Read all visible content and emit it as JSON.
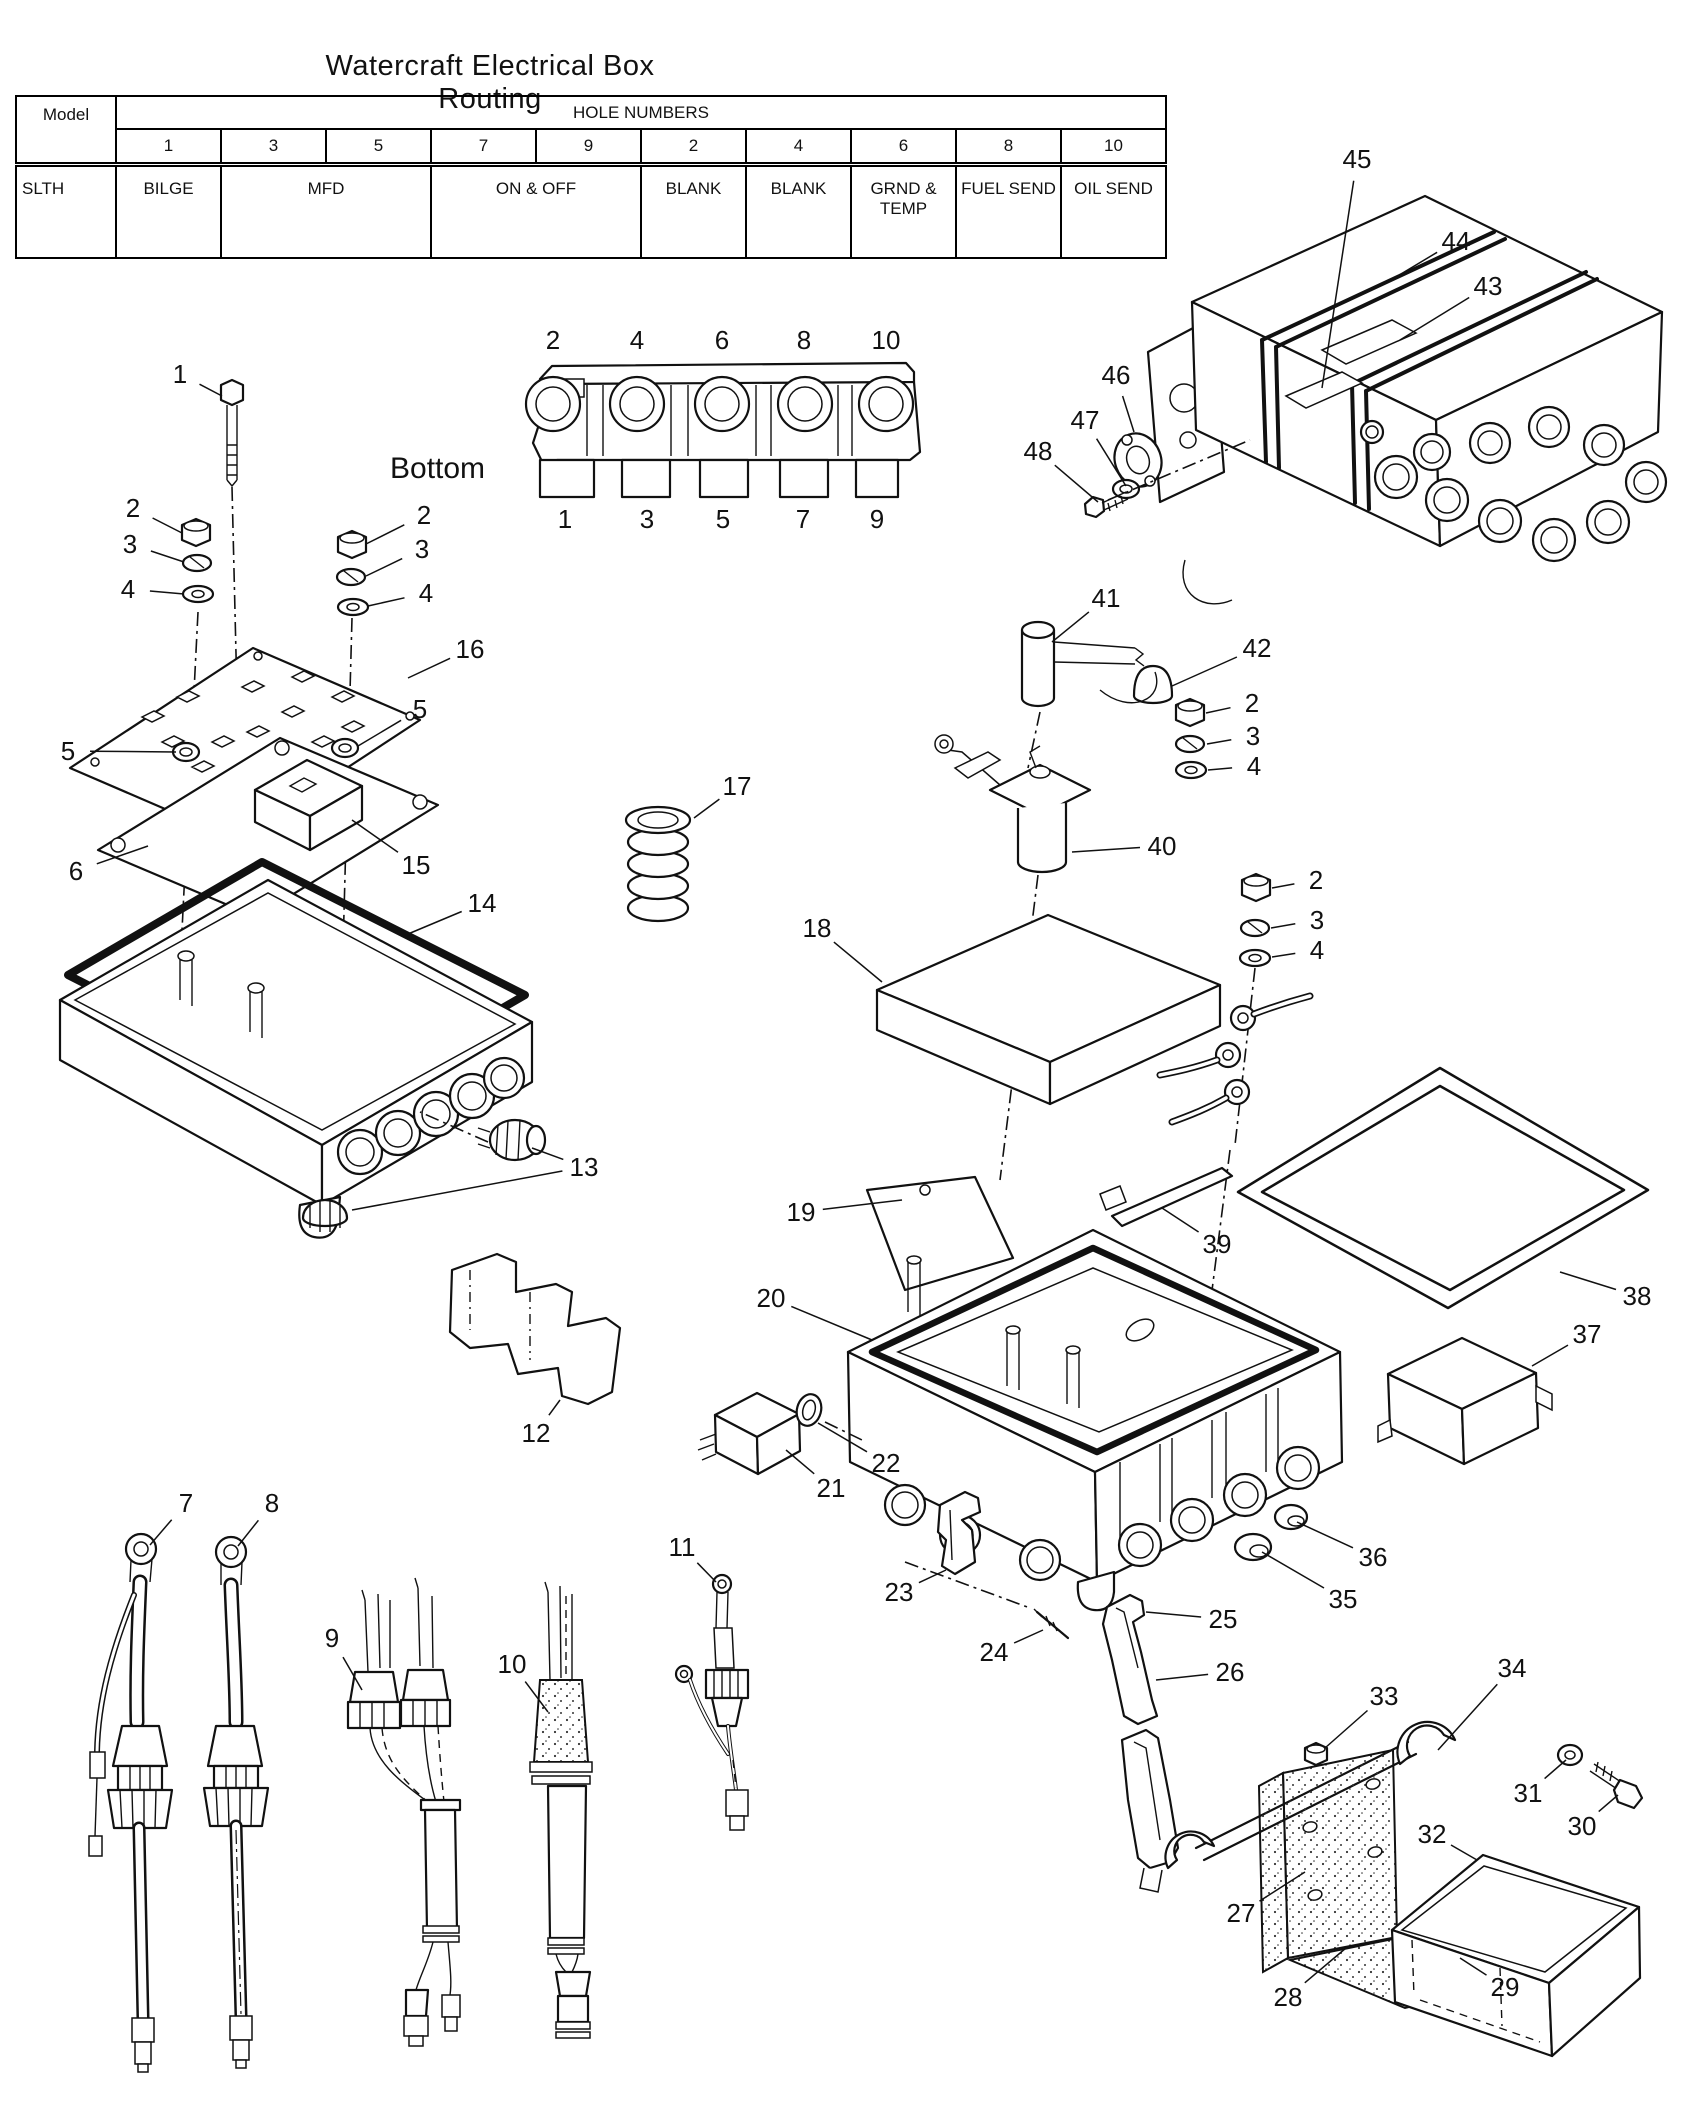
{
  "title": "Watercraft Electrical Box Routing",
  "table": {
    "model_header": "Model",
    "group_header": "HOLE NUMBERS",
    "hole_numbers": [
      "1",
      "3",
      "5",
      "7",
      "9",
      "2",
      "4",
      "6",
      "8",
      "10"
    ],
    "model_value": "SLTH",
    "assignments": [
      {
        "label": "BILGE",
        "span": 1
      },
      {
        "label": "MFD",
        "span": 2
      },
      {
        "label": "ON & OFF",
        "span": 2
      },
      {
        "label": "BLANK",
        "span": 1
      },
      {
        "label": "BLANK",
        "span": 1
      },
      {
        "label": "GRND & TEMP",
        "span": 1
      },
      {
        "label": "FUEL SEND",
        "span": 1
      },
      {
        "label": "OIL SEND",
        "span": 1
      }
    ]
  },
  "bottom_view": {
    "label": "Bottom",
    "top_row": [
      {
        "n": "2",
        "x": 553
      },
      {
        "n": "4",
        "x": 637
      },
      {
        "n": "6",
        "x": 722
      },
      {
        "n": "8",
        "x": 804
      },
      {
        "n": "10",
        "x": 886
      }
    ],
    "bottom_row": [
      {
        "n": "1",
        "x": 565
      },
      {
        "n": "3",
        "x": 647
      },
      {
        "n": "5",
        "x": 723
      },
      {
        "n": "7",
        "x": 803
      },
      {
        "n": "9",
        "x": 877
      }
    ]
  },
  "callouts": [
    {
      "label": "1",
      "x": 180,
      "y": 383,
      "tx": 222,
      "ty": 396
    },
    {
      "label": "2",
      "x": 133,
      "y": 517,
      "tx": 182,
      "ty": 533
    },
    {
      "label": "3",
      "x": 130,
      "y": 553,
      "tx": 184,
      "ty": 562
    },
    {
      "label": "4",
      "x": 128,
      "y": 598,
      "tx": 184,
      "ty": 594
    },
    {
      "label": "2",
      "x": 424,
      "y": 524,
      "tx": 366,
      "ty": 544
    },
    {
      "label": "3",
      "x": 422,
      "y": 558,
      "tx": 366,
      "ty": 576
    },
    {
      "label": "4",
      "x": 426,
      "y": 602,
      "tx": 368,
      "ty": 606
    },
    {
      "label": "5",
      "x": 68,
      "y": 760,
      "tx": 176,
      "ty": 752
    },
    {
      "label": "5",
      "x": 420,
      "y": 718,
      "tx": 358,
      "ty": 746
    },
    {
      "label": "16",
      "x": 470,
      "y": 658,
      "tx": 408,
      "ty": 678
    },
    {
      "label": "6",
      "x": 76,
      "y": 880,
      "tx": 148,
      "ty": 846
    },
    {
      "label": "15",
      "x": 416,
      "y": 874,
      "tx": 352,
      "ty": 820
    },
    {
      "label": "14",
      "x": 482,
      "y": 912,
      "tx": 408,
      "ty": 934
    },
    {
      "label": "13",
      "x": 584,
      "y": 1176,
      "tx": 532,
      "ty": 1148,
      "tx2": 352,
      "ty2": 1210
    },
    {
      "label": "12",
      "x": 536,
      "y": 1442,
      "tx": 560,
      "ty": 1400
    },
    {
      "label": "7",
      "x": 186,
      "y": 1512,
      "tx": 150,
      "ty": 1545
    },
    {
      "label": "8",
      "x": 272,
      "y": 1512,
      "tx": 238,
      "ty": 1546
    },
    {
      "label": "9",
      "x": 332,
      "y": 1647,
      "tx": 362,
      "ty": 1690
    },
    {
      "label": "10",
      "x": 512,
      "y": 1673,
      "tx": 548,
      "ty": 1712
    },
    {
      "label": "11",
      "x": 682,
      "y": 1556,
      "tx": 716,
      "ty": 1582
    },
    {
      "label": "17",
      "x": 737,
      "y": 795,
      "tx": 694,
      "ty": 818
    },
    {
      "label": "18",
      "x": 817,
      "y": 937,
      "tx": 882,
      "ty": 982
    },
    {
      "label": "40",
      "x": 1162,
      "y": 855,
      "tx": 1072,
      "ty": 852
    },
    {
      "label": "41",
      "x": 1106,
      "y": 607,
      "tx": 1052,
      "ty": 642
    },
    {
      "label": "42",
      "x": 1257,
      "y": 657,
      "tx": 1172,
      "ty": 686
    },
    {
      "label": "2",
      "x": 1252,
      "y": 712,
      "tx": 1206,
      "ty": 713
    },
    {
      "label": "3",
      "x": 1253,
      "y": 745,
      "tx": 1207,
      "ty": 744
    },
    {
      "label": "4",
      "x": 1254,
      "y": 775,
      "tx": 1208,
      "ty": 770
    },
    {
      "label": "2",
      "x": 1316,
      "y": 889,
      "tx": 1272,
      "ty": 888
    },
    {
      "label": "3",
      "x": 1317,
      "y": 929,
      "tx": 1271,
      "ty": 928
    },
    {
      "label": "4",
      "x": 1317,
      "y": 959,
      "tx": 1272,
      "ty": 957
    },
    {
      "label": "19",
      "x": 801,
      "y": 1221,
      "tx": 902,
      "ty": 1200
    },
    {
      "label": "20",
      "x": 771,
      "y": 1307,
      "tx": 872,
      "ty": 1340
    },
    {
      "label": "21",
      "x": 831,
      "y": 1497,
      "tx": 786,
      "ty": 1450
    },
    {
      "label": "22",
      "x": 886,
      "y": 1472,
      "tx": 818,
      "ty": 1423
    },
    {
      "label": "23",
      "x": 899,
      "y": 1601,
      "tx": 946,
      "ty": 1570
    },
    {
      "label": "24",
      "x": 994,
      "y": 1661,
      "tx": 1043,
      "ty": 1630
    },
    {
      "label": "25",
      "x": 1223,
      "y": 1628,
      "tx": 1146,
      "ty": 1612
    },
    {
      "label": "26",
      "x": 1230,
      "y": 1681,
      "tx": 1156,
      "ty": 1680
    },
    {
      "label": "35",
      "x": 1343,
      "y": 1608,
      "tx": 1262,
      "ty": 1552
    },
    {
      "label": "36",
      "x": 1373,
      "y": 1566,
      "tx": 1297,
      "ty": 1522
    },
    {
      "label": "37",
      "x": 1587,
      "y": 1343,
      "tx": 1532,
      "ty": 1366
    },
    {
      "label": "38",
      "x": 1637,
      "y": 1305,
      "tx": 1560,
      "ty": 1272
    },
    {
      "label": "39",
      "x": 1217,
      "y": 1253,
      "tx": 1162,
      "ty": 1208
    },
    {
      "label": "43",
      "x": 1488,
      "y": 295,
      "tx": 1400,
      "ty": 340
    },
    {
      "label": "44",
      "x": 1456,
      "y": 250,
      "tx": 1396,
      "ty": 277
    },
    {
      "label": "45",
      "x": 1357,
      "y": 168,
      "tx": 1322,
      "ty": 388
    },
    {
      "label": "46",
      "x": 1116,
      "y": 384,
      "tx": 1134,
      "ty": 432
    },
    {
      "label": "47",
      "x": 1085,
      "y": 429,
      "tx": 1126,
      "ty": 486
    },
    {
      "label": "48",
      "x": 1038,
      "y": 460,
      "tx": 1098,
      "ty": 502
    },
    {
      "label": "27",
      "x": 1241,
      "y": 1922,
      "tx": 1305,
      "ty": 1872
    },
    {
      "label": "28",
      "x": 1288,
      "y": 2006,
      "tx": 1346,
      "ty": 1948
    },
    {
      "label": "29",
      "x": 1505,
      "y": 1996,
      "tx": 1460,
      "ty": 1958
    },
    {
      "label": "30",
      "x": 1582,
      "y": 1835,
      "tx": 1618,
      "ty": 1795
    },
    {
      "label": "31",
      "x": 1528,
      "y": 1802,
      "tx": 1566,
      "ty": 1760
    },
    {
      "label": "32",
      "x": 1432,
      "y": 1843,
      "tx": 1477,
      "ty": 1860
    },
    {
      "label": "33",
      "x": 1384,
      "y": 1705,
      "tx": 1325,
      "ty": 1748
    },
    {
      "label": "34",
      "x": 1512,
      "y": 1677,
      "tx": 1438,
      "ty": 1750
    }
  ]
}
